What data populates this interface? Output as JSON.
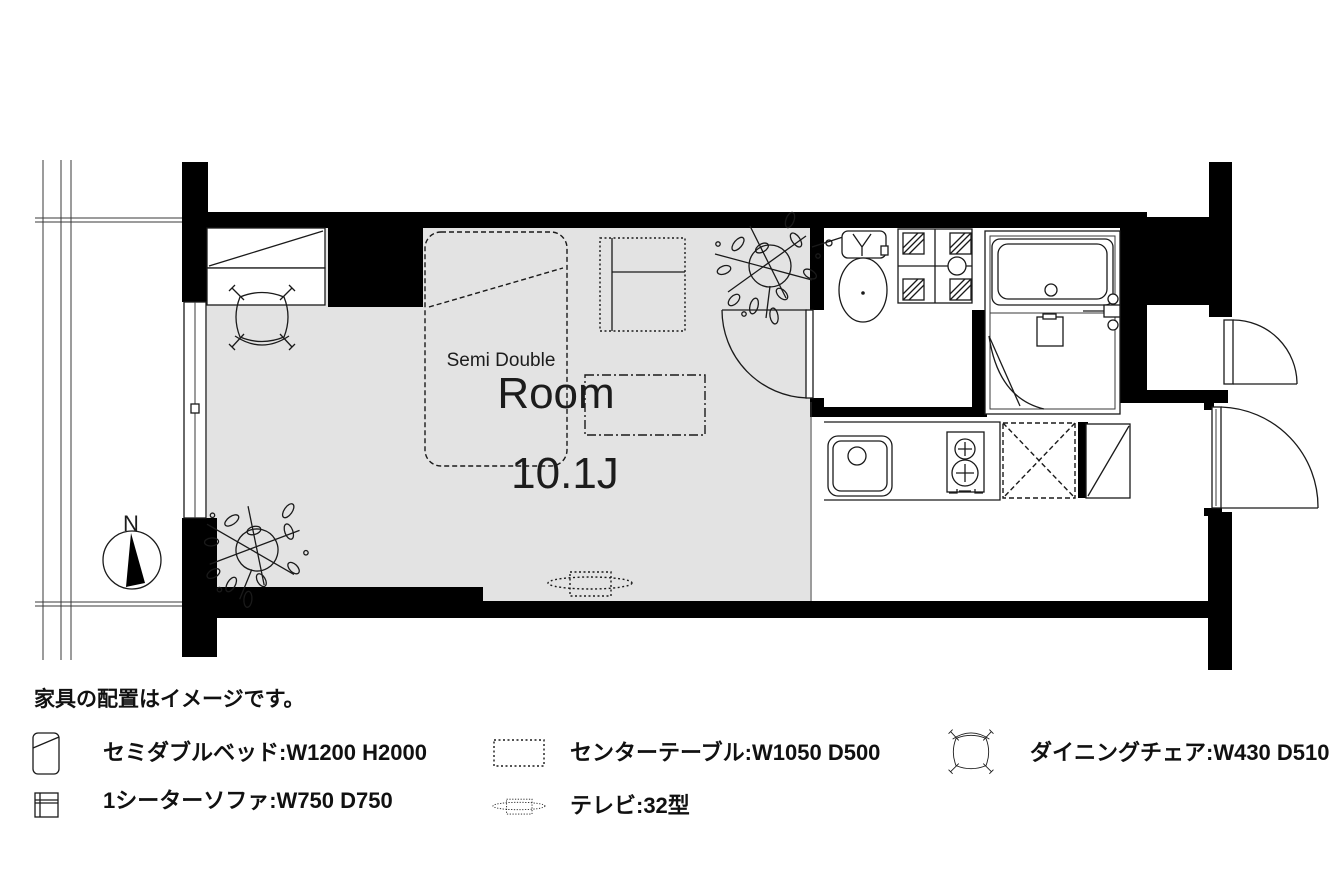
{
  "note": "家具の配置はイメージです。",
  "room": {
    "name": "Room",
    "size": "10.1J",
    "bed_label": "Semi Double",
    "compass": "N"
  },
  "legend": {
    "items": [
      {
        "icon": "bed-icon",
        "label": "セミダブルベッド:W1200 H2000"
      },
      {
        "icon": "sofa-icon",
        "label": "1シーターソファ:W750 D750"
      },
      {
        "icon": "table-icon",
        "label": "センターテーブル:W1050 D500"
      },
      {
        "icon": "tv-icon",
        "label": "テレビ:32型"
      },
      {
        "icon": "chair-icon",
        "label": "ダイニングチェア:W430 D510"
      }
    ]
  },
  "colors": {
    "wall": "#000000",
    "floor": "#e3e3e3",
    "line": "#1a1a1a",
    "background": "#ffffff"
  }
}
